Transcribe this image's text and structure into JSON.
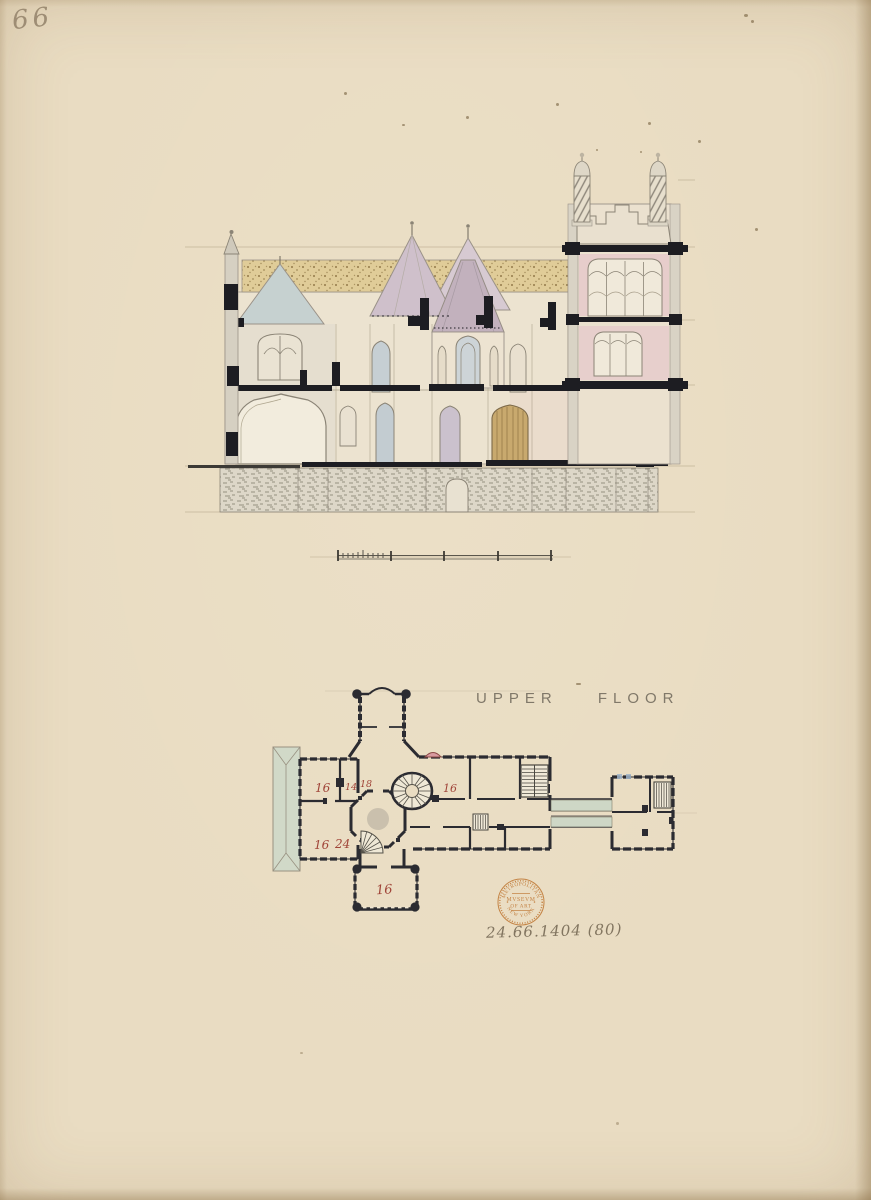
{
  "page": {
    "folio_number": "66",
    "accession_number": "24.66.1404 (80)"
  },
  "plan": {
    "title": "UPPER FLOOR",
    "rooms": [
      "16",
      "14",
      "18",
      "16",
      "16",
      "24",
      "16"
    ]
  },
  "stamp": {
    "arc_top": "METROPOLITAN",
    "center_line1": "MVSEVM",
    "center_line2": "OF ART",
    "arc_bottom": "NEW YORK"
  },
  "colors": {
    "paper": "#e9dcc2",
    "ink_black": "#1d1d22",
    "pencil_grey": "#8b8476",
    "roof_tan": "#e0cc98",
    "roof_lavender": "#cfc0cb",
    "gable_blue": "#c6d1d0",
    "tower_pink": "#e7cdcb",
    "plan_green": "#cbd7c7",
    "bay_pink": "#d89aa0",
    "room_number_red": "#a04438",
    "stamp_orange": "#bf7733",
    "graphite": "#827560"
  }
}
